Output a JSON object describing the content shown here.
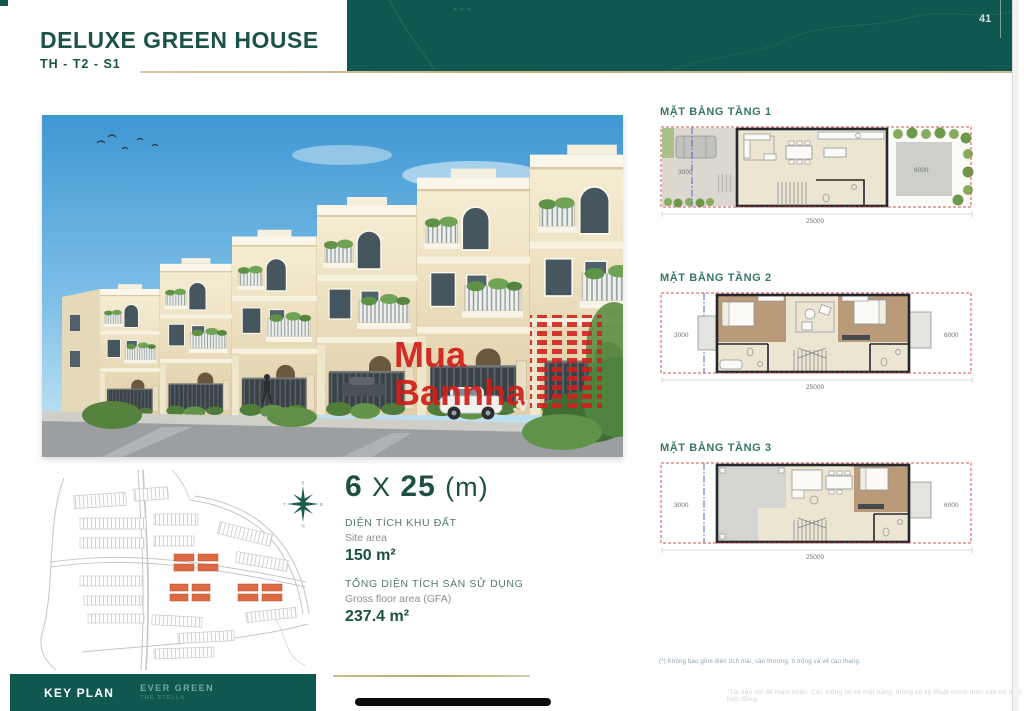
{
  "page": {
    "number": "41"
  },
  "header": {
    "title": "DELUXE GREEN HOUSE",
    "subtitle": "TH - T2 - S1"
  },
  "floor_plans": [
    {
      "label": "MẶT BẰNG TẦNG 1",
      "dim_left": "3000",
      "dim_right": "6000",
      "dim_bottom": "25000"
    },
    {
      "label": "MẶT BẰNG TẦNG 2",
      "dim_left": "3000",
      "dim_right": "6000",
      "dim_bottom": "25000"
    },
    {
      "label": "MẶT BẰNG TẦNG 3",
      "dim_left": "3000",
      "dim_right": "6000",
      "dim_bottom": "25000"
    }
  ],
  "specs": {
    "lot_width": "6",
    "times": "X",
    "lot_depth": "25",
    "unit": "(m)",
    "site_area_label_vi": "DIỆN TÍCH KHU ĐẤT",
    "site_area_label_en": "Site area",
    "site_area_value": "150 m²",
    "gfa_label_vi": "TỔNG DIỆN TÍCH SÀN SỬ DỤNG",
    "gfa_label_en": "Gross floor area (GFA)",
    "gfa_value": "237.4 m²"
  },
  "compass": {
    "north": "B",
    "east": "Đ",
    "south": "N",
    "west": "T"
  },
  "key_plan": {
    "label": "KEY PLAN",
    "project": "EVER GREEN",
    "project_sub": "THE STELLA"
  },
  "watermark": {
    "line1": "Mua",
    "line2": "Bannha",
    "suffix": ".vn"
  },
  "footnotes": {
    "note1": "(*) Không bao gồm diện tích mái, sân thượng, ô trống và vế cầu thang.",
    "note2": "*Tài liệu chỉ để tham khảo. Các thông tin về mặt bằng, thông số kỹ thuật chính thức căn cứ theo hợp đồng."
  },
  "colors": {
    "brand_teal": "#10584f",
    "accent_gold": "#c7b27e",
    "highlight_orange": "#dd6a44",
    "watermark_red": "#d01f1a"
  }
}
